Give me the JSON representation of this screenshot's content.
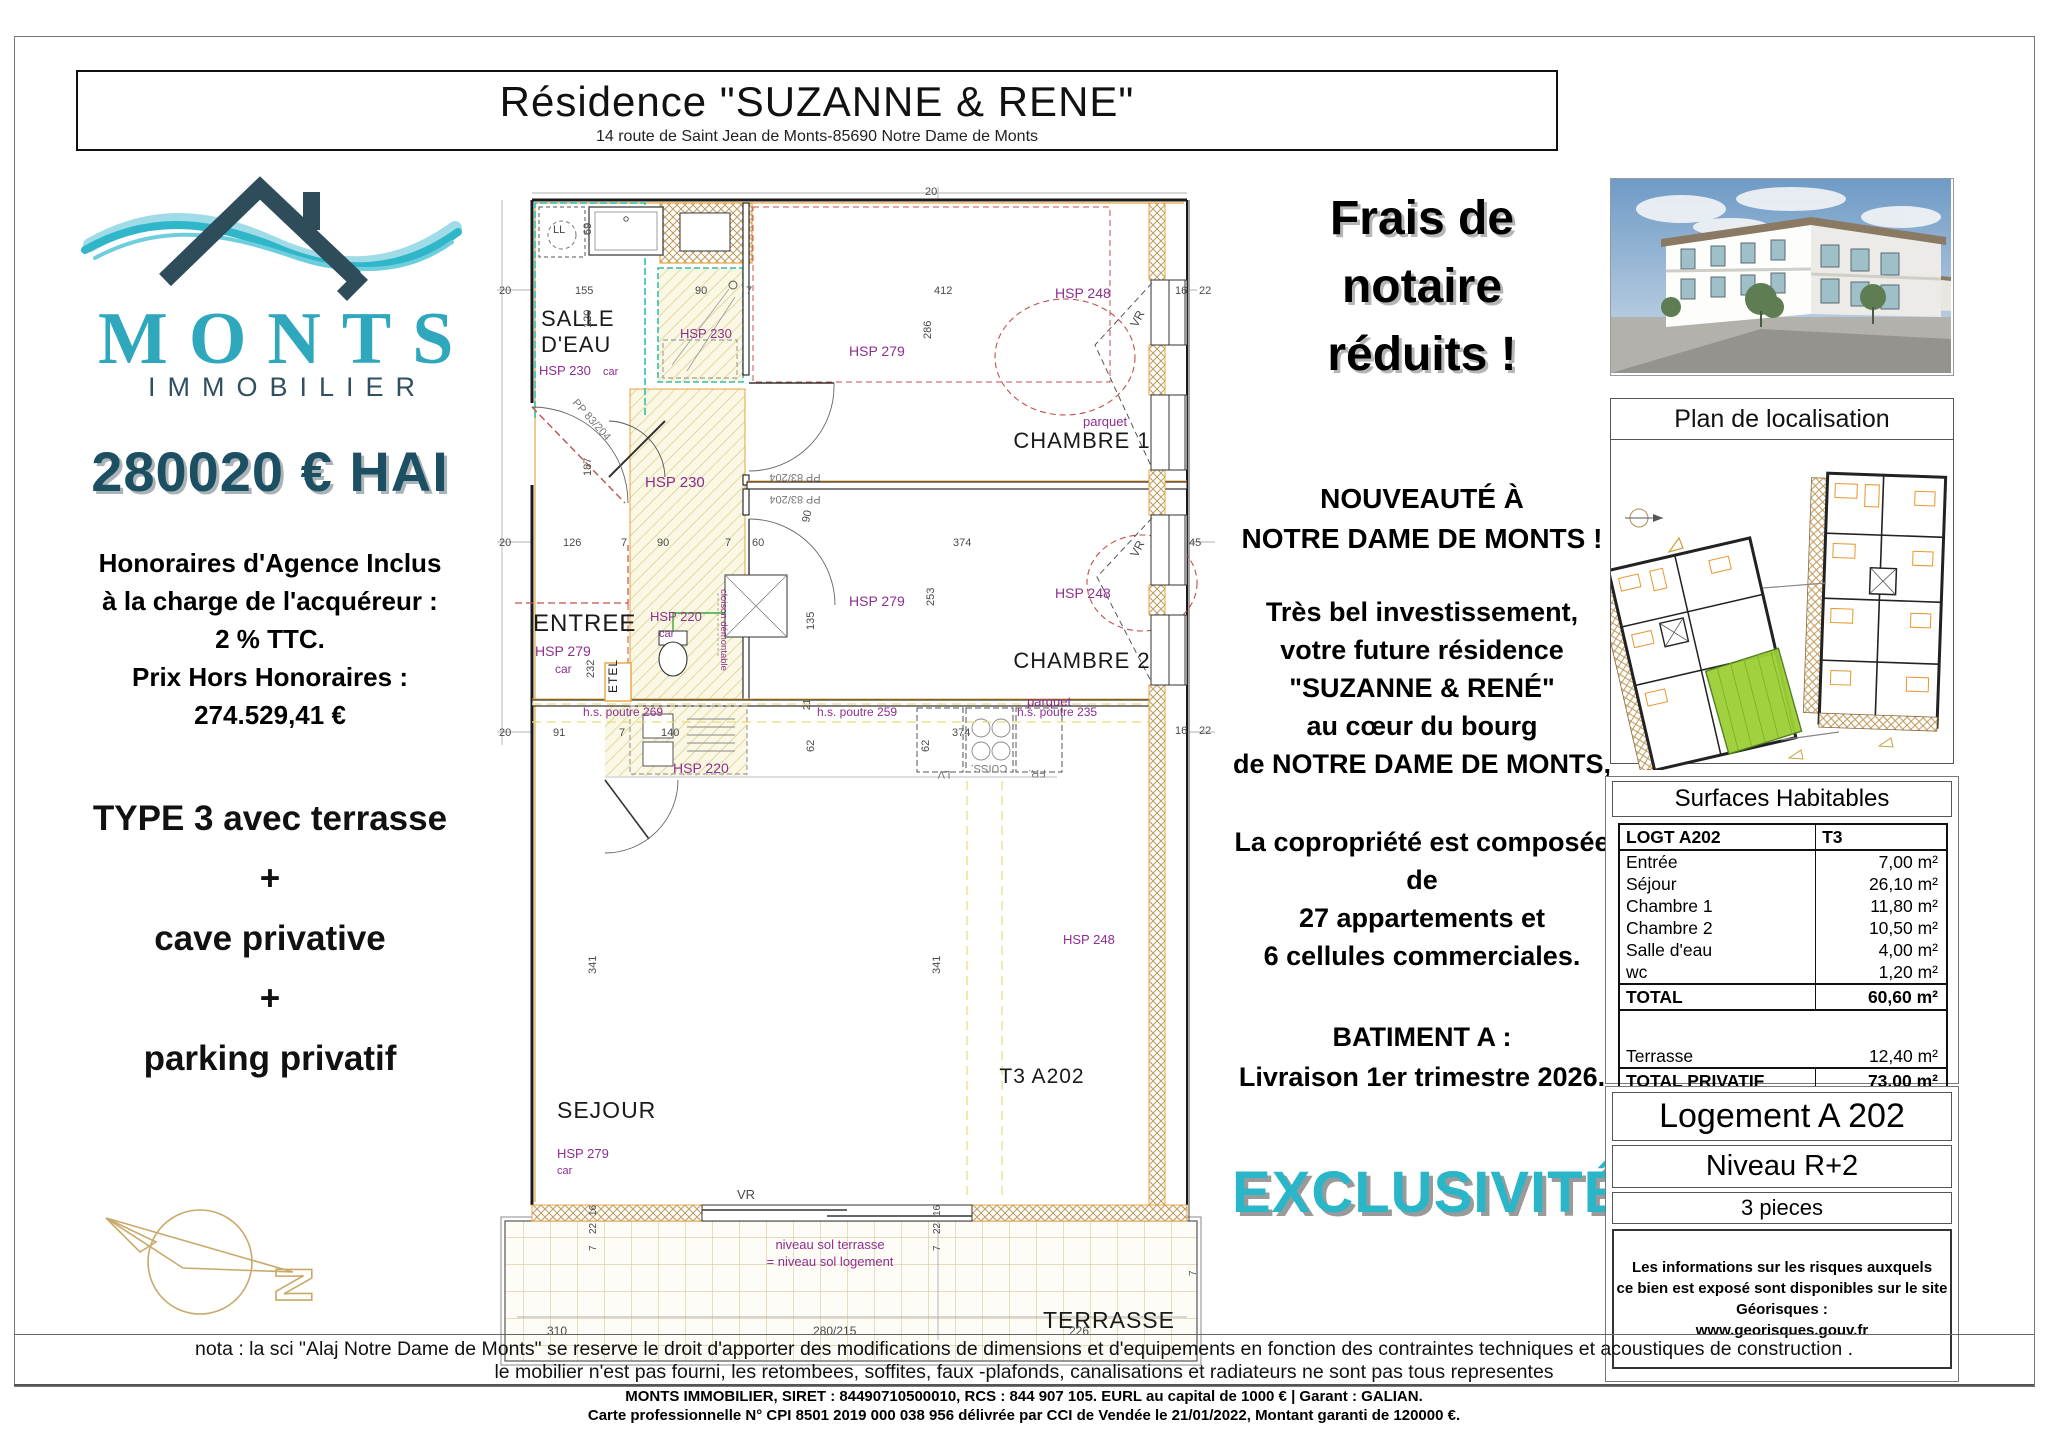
{
  "header": {
    "title": "Résidence \"SUZANNE & RENE\"",
    "address": "14 route de Saint Jean de Monts-85690 Notre Dame de Monts"
  },
  "brand": {
    "name": "MONTS",
    "subtitle": "IMMOBILIER",
    "teal": "#2fa8bd",
    "dark": "#31505f"
  },
  "offer": {
    "price": "280020 € HAI",
    "fees_lines": [
      "Honoraires d'Agence Inclus",
      "à la charge de l'acquéreur :",
      "2 % TTC.",
      "Prix Hors Honoraires :",
      "274.529,41 €"
    ],
    "type_lines": [
      "TYPE 3 avec terrasse",
      "+",
      "cave privative",
      "+",
      "parking privatif"
    ]
  },
  "promo": {
    "banner_lines": [
      "Frais de",
      "notaire",
      "réduits !"
    ],
    "news_lines": [
      "NOUVEAUTÉ À",
      "NOTRE DAME DE MONTS !"
    ],
    "pitch_lines": [
      "Très bel investissement,",
      "votre future résidence",
      "\"SUZANNE & RENÉ\"",
      "au cœur du bourg",
      "de NOTRE DAME DE MONTS,"
    ],
    "copro_lines": [
      "La copropriété est composée de",
      "27 appartements et",
      "6 cellules commerciales."
    ],
    "delivery_lines": [
      "BATIMENT A :",
      "Livraison 1er trimestre 2026."
    ],
    "exclusive": "EXCLUSIVITÉ"
  },
  "localisation": {
    "title": "Plan de localisation"
  },
  "surfaces": {
    "title": "Surfaces Habitables",
    "header": {
      "left": "LOGT A202",
      "right": "T3"
    },
    "rows": [
      {
        "label": "Entrée",
        "value": "7,00 m²"
      },
      {
        "label": "Séjour",
        "value": "26,10 m²"
      },
      {
        "label": "Chambre 1",
        "value": "11,80 m²"
      },
      {
        "label": "Chambre 2",
        "value": "10,50 m²"
      },
      {
        "label": "Salle d'eau",
        "value": "4,00 m²"
      },
      {
        "label": "wc",
        "value": "1,20 m²"
      }
    ],
    "total": {
      "label": "TOTAL",
      "value": "60,60 m²"
    },
    "terrace": {
      "label": "Terrasse",
      "value": "12,40 m²"
    },
    "total_privatif": {
      "label": "TOTAL PRIVATIF",
      "value": "73,00 m²"
    }
  },
  "unit": {
    "name": "Logement A 202",
    "level": "Niveau R+2",
    "rooms": "3 pieces",
    "risks_lines": [
      "Les informations sur les risques auxquels",
      "ce bien est exposé sont disponibles sur le site Géorisques :",
      "www.georisques.gouv.fr"
    ]
  },
  "nota_lines": [
    "nota : la sci \"Alaj Notre Dame de Monts\" se reserve le droit d'apporter des modifications de dimensions et d'equipements en fonction des contraintes techniques et acoustiques de construction .",
    "le mobilier n'est pas fourni, les retombees, soffites, faux -plafonds, canalisations et  radiateurs ne sont pas tous representes"
  ],
  "footer_lines": [
    "MONTS IMMOBILIER, SIRET : 84490710500010, RCS : 844 907 105. EURL au capital de 1000 € | Garant : GALIAN.",
    "Carte professionnelle N° CPI 8501 2019 000 038 956 délivrée par CCI de Vendée le 21/01/2022, Montant garanti de 120000 €."
  ],
  "floorplan": {
    "unit_label": "T3 A202",
    "labels": [
      {
        "t": "SALLE",
        "x": 44,
        "y": 141,
        "c": "r",
        "s": 22
      },
      {
        "t": "D'EAU",
        "x": 44,
        "y": 167,
        "c": "r",
        "s": 22
      },
      {
        "t": "ENTREE",
        "x": 36,
        "y": 446,
        "c": "r",
        "s": 24
      },
      {
        "t": "CHAMBRE 1",
        "x": 585,
        "y": 263,
        "c": "r",
        "s": 22,
        "a": "m"
      },
      {
        "t": "CHAMBRE 2",
        "x": 585,
        "y": 483,
        "c": "r",
        "s": 22,
        "a": "m"
      },
      {
        "t": "SEJOUR",
        "x": 60,
        "y": 933,
        "c": "r",
        "s": 23
      },
      {
        "t": "T3 A202",
        "x": 545,
        "y": 898,
        "c": "r",
        "s": 21,
        "a": "m"
      },
      {
        "t": "TERRASSE",
        "x": 612,
        "y": 1143,
        "c": "r",
        "s": 23,
        "a": "m"
      },
      {
        "t": "ETEL",
        "x": 120,
        "y": 508,
        "c": "r",
        "s": 12,
        "rot": -90
      },
      {
        "t": "LL",
        "x": 56,
        "y": 48,
        "c": "d",
        "s": 11
      },
      {
        "t": "VR",
        "x": 240,
        "y": 1014,
        "c": "d",
        "s": 13
      },
      {
        "t": "HSP 230",
        "x": 42,
        "y": 190,
        "c": "h",
        "s": 13
      },
      {
        "t": "car",
        "x": 106,
        "y": 190,
        "c": "h",
        "s": 11
      },
      {
        "t": "HSP 230",
        "x": 183,
        "y": 153,
        "c": "h",
        "s": 13
      },
      {
        "t": "HSP 230",
        "x": 148,
        "y": 302,
        "c": "h",
        "s": 15
      },
      {
        "t": "HSP 279",
        "x": 38,
        "y": 471,
        "c": "h",
        "s": 14
      },
      {
        "t": "car",
        "x": 58,
        "y": 488,
        "c": "h",
        "s": 12
      },
      {
        "t": "HSP 279",
        "x": 352,
        "y": 171,
        "c": "h",
        "s": 14
      },
      {
        "t": "HSP 279",
        "x": 352,
        "y": 421,
        "c": "h",
        "s": 14
      },
      {
        "t": "HSP 220",
        "x": 153,
        "y": 436,
        "c": "h",
        "s": 13
      },
      {
        "t": "car",
        "x": 162,
        "y": 452,
        "c": "h",
        "s": 11
      },
      {
        "t": "HSP 220",
        "x": 176,
        "y": 588,
        "c": "h",
        "s": 14
      },
      {
        "t": "HSP 248",
        "x": 558,
        "y": 113,
        "c": "h",
        "s": 14
      },
      {
        "t": "HSP 248",
        "x": 558,
        "y": 413,
        "c": "h",
        "s": 14
      },
      {
        "t": "HSP 248",
        "x": 566,
        "y": 759,
        "c": "h",
        "s": 13
      },
      {
        "t": "HSP 279",
        "x": 60,
        "y": 973,
        "c": "h",
        "s": 13
      },
      {
        "t": "car",
        "x": 60,
        "y": 989,
        "c": "h",
        "s": 11
      },
      {
        "t": "parquet",
        "x": 586,
        "y": 241,
        "c": "h",
        "s": 13
      },
      {
        "t": "parquet",
        "x": 530,
        "y": 521,
        "c": "h",
        "s": 13
      },
      {
        "t": "h.s. poutre 269",
        "x": 86,
        "y": 531,
        "c": "h",
        "s": 12
      },
      {
        "t": "h.s. poutre 259",
        "x": 320,
        "y": 531,
        "c": "h",
        "s": 12
      },
      {
        "t": "h.s. poutre 235",
        "x": 520,
        "y": 531,
        "c": "h",
        "s": 12
      },
      {
        "t": "cloison démontable",
        "x": 224,
        "y": 445,
        "c": "h",
        "s": 9.5,
        "rot": 90,
        "a": "m"
      },
      {
        "t": "niveau sol terrasse",
        "x": 333,
        "y": 1064,
        "c": "h",
        "s": 13,
        "a": "m"
      },
      {
        "t": "= niveau sol logement",
        "x": 333,
        "y": 1081,
        "c": "h",
        "s": 13,
        "a": "m"
      },
      {
        "t": "PP 83/204",
        "x": 75,
        "y": 218,
        "c": "o",
        "s": 11,
        "rot": 48
      },
      {
        "t": "PP 83/204",
        "x": 298,
        "y": 289,
        "c": "o",
        "s": 11,
        "rot": 180,
        "a": "m"
      },
      {
        "t": "PP 83/204",
        "x": 298,
        "y": 311,
        "c": "o",
        "s": 11,
        "rot": 180,
        "a": "m"
      },
      {
        "t": "LV",
        "x": 447,
        "y": 586,
        "c": "o",
        "s": 11,
        "rot": 180,
        "a": "m"
      },
      {
        "t": "CUISS.",
        "x": 492,
        "y": 580,
        "c": "o",
        "s": 11,
        "rot": 180,
        "a": "m"
      },
      {
        "t": "FR.",
        "x": 540,
        "y": 585,
        "c": "o",
        "s": 11,
        "rot": 180,
        "a": "m"
      },
      {
        "t": "VR",
        "x": 640,
        "y": 143,
        "c": "d",
        "s": 12,
        "rot": -62
      },
      {
        "t": "VR",
        "x": 640,
        "y": 373,
        "c": "d",
        "s": 12,
        "rot": -62
      },
      {
        "t": "20",
        "x": 428,
        "y": 10,
        "c": "d",
        "s": 11
      },
      {
        "t": "20",
        "x": 2,
        "y": 109,
        "c": "d",
        "s": 11
      },
      {
        "t": "155",
        "x": 78,
        "y": 109,
        "c": "d",
        "s": 11
      },
      {
        "t": "90",
        "x": 198,
        "y": 109,
        "c": "d",
        "s": 11
      },
      {
        "t": "7",
        "x": 249,
        "y": 109,
        "c": "d",
        "s": 11
      },
      {
        "t": "412",
        "x": 437,
        "y": 109,
        "c": "d",
        "s": 11
      },
      {
        "t": "16",
        "x": 678,
        "y": 109,
        "c": "d",
        "s": 11
      },
      {
        "t": "22",
        "x": 702,
        "y": 109,
        "c": "d",
        "s": 11
      },
      {
        "t": "69",
        "x": 94,
        "y": 50,
        "c": "d",
        "s": 11,
        "rot": -90
      },
      {
        "t": "120",
        "x": 94,
        "y": 143,
        "c": "d",
        "s": 11,
        "rot": -90
      },
      {
        "t": "187",
        "x": 94,
        "y": 291,
        "c": "d",
        "s": 11,
        "rot": -90
      },
      {
        "t": "286",
        "x": 434,
        "y": 154,
        "c": "d",
        "s": 11,
        "rot": -90
      },
      {
        "t": "232",
        "x": 97,
        "y": 493,
        "c": "d",
        "s": 11,
        "rot": -90
      },
      {
        "t": "253",
        "x": 437,
        "y": 421,
        "c": "d",
        "s": 11,
        "rot": -90
      },
      {
        "t": "135",
        "x": 317,
        "y": 445,
        "c": "d",
        "s": 11,
        "rot": -90
      },
      {
        "t": "21",
        "x": 313,
        "y": 525,
        "c": "d",
        "s": 10,
        "rot": -90
      },
      {
        "t": "62",
        "x": 317,
        "y": 567,
        "c": "d",
        "s": 11,
        "rot": -90
      },
      {
        "t": "62",
        "x": 432,
        "y": 567,
        "c": "d",
        "s": 11,
        "rot": -90
      },
      {
        "t": "341",
        "x": 99,
        "y": 789,
        "c": "d",
        "s": 11,
        "rot": -90
      },
      {
        "t": "341",
        "x": 443,
        "y": 789,
        "c": "d",
        "s": 11,
        "rot": -90
      },
      {
        "t": "90",
        "x": 312,
        "y": 338,
        "c": "d",
        "s": 11,
        "rot": -78
      },
      {
        "t": "20",
        "x": 2,
        "y": 361,
        "c": "d",
        "s": 11
      },
      {
        "t": "126",
        "x": 66,
        "y": 361,
        "c": "d",
        "s": 11
      },
      {
        "t": "7",
        "x": 124,
        "y": 361,
        "c": "d",
        "s": 11
      },
      {
        "t": "90",
        "x": 160,
        "y": 361,
        "c": "d",
        "s": 11
      },
      {
        "t": "7",
        "x": 228,
        "y": 361,
        "c": "d",
        "s": 11
      },
      {
        "t": "60",
        "x": 255,
        "y": 361,
        "c": "d",
        "s": 11
      },
      {
        "t": "374",
        "x": 456,
        "y": 361,
        "c": "d",
        "s": 11
      },
      {
        "t": "45",
        "x": 692,
        "y": 361,
        "c": "d",
        "s": 11
      },
      {
        "t": "20",
        "x": 2,
        "y": 551,
        "c": "d",
        "s": 11
      },
      {
        "t": "91",
        "x": 56,
        "y": 551,
        "c": "d",
        "s": 11
      },
      {
        "t": "7",
        "x": 122,
        "y": 551,
        "c": "d",
        "s": 11
      },
      {
        "t": "140",
        "x": 164,
        "y": 551,
        "c": "d",
        "s": 11
      },
      {
        "t": "374",
        "x": 455,
        "y": 551,
        "c": "d",
        "s": 11
      },
      {
        "t": "16",
        "x": 678,
        "y": 549,
        "c": "d",
        "s": 11
      },
      {
        "t": "22",
        "x": 702,
        "y": 549,
        "c": "d",
        "s": 11
      },
      {
        "t": "16",
        "x": 99,
        "y": 1031,
        "c": "d",
        "s": 10,
        "rot": -90
      },
      {
        "t": "22",
        "x": 99,
        "y": 1049,
        "c": "d",
        "s": 10,
        "rot": -90
      },
      {
        "t": "7",
        "x": 99,
        "y": 1066,
        "c": "d",
        "s": 10,
        "rot": -90
      },
      {
        "t": "16",
        "x": 443,
        "y": 1031,
        "c": "d",
        "s": 10,
        "rot": -90
      },
      {
        "t": "22",
        "x": 443,
        "y": 1049,
        "c": "d",
        "s": 10,
        "rot": -90
      },
      {
        "t": "7",
        "x": 443,
        "y": 1066,
        "c": "d",
        "s": 10,
        "rot": -90
      },
      {
        "t": "7",
        "x": 699,
        "y": 1091,
        "c": "d",
        "s": 10,
        "rot": -90
      },
      {
        "t": "310",
        "x": 50,
        "y": 1150,
        "c": "d",
        "s": 12
      },
      {
        "t": "280/215",
        "x": 316,
        "y": 1150,
        "c": "d",
        "s": 12
      },
      {
        "t": "226",
        "x": 572,
        "y": 1150,
        "c": "d",
        "s": 12
      }
    ]
  }
}
